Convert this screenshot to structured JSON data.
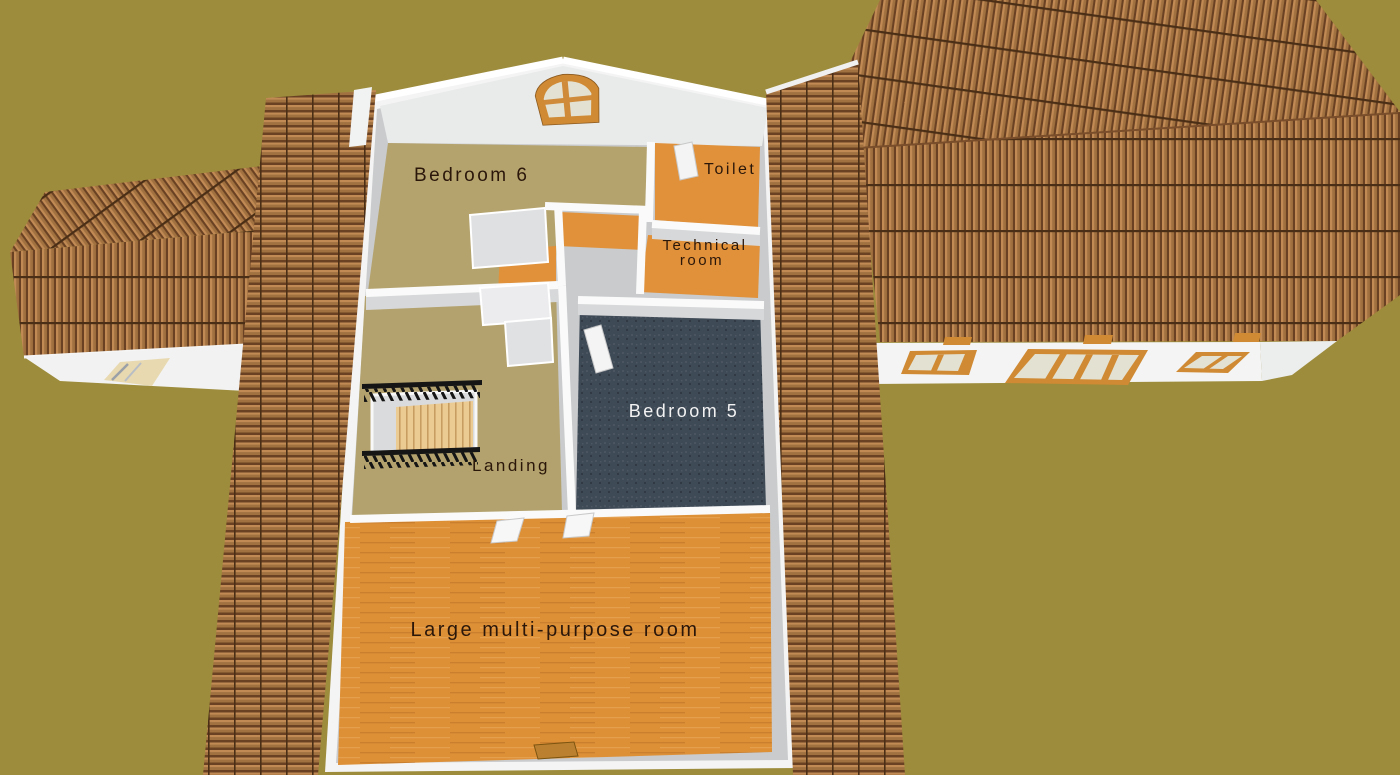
{
  "view": {
    "type": "3d-aerial-home-view",
    "background_color": "#9d8c3b"
  },
  "rooms": [
    {
      "id": "bedroom-6",
      "label": "Bedroom 6",
      "floor_color": "#b5a36e",
      "label_color": "#2b170a"
    },
    {
      "id": "toilet",
      "label": "Toilet",
      "floor_color": "#e0913a",
      "label_color": "#2b170a"
    },
    {
      "id": "technical-room",
      "label": "Technical room",
      "label_line1": "Technical",
      "label_line2": "room",
      "floor_color": "#e0913a",
      "label_color": "#2b170a"
    },
    {
      "id": "bedroom-5",
      "label": "Bedroom 5",
      "floor_color": "#3f4a57",
      "label_color": "#f2f2f2"
    },
    {
      "id": "landing",
      "label": "Landing",
      "floor_color": "#b3a26d",
      "label_color": "#2b170a"
    },
    {
      "id": "large-multi-purpose-room",
      "label": "Large multi-purpose room",
      "floor_color": "#de9037",
      "label_color": "#2b170a"
    }
  ],
  "colors": {
    "roof_tile_mid": "#a1713f",
    "roof_tile_light": "#c18a55",
    "roof_tile_dark": "#6a4223",
    "roof_tile_groove": "#4a2e15",
    "wall_white": "#f4f4f4",
    "wall_gray": "#c9cbcc",
    "window_frame": "#d08a33",
    "window_glass": "#e3e1d2",
    "stair_rail": "#151515",
    "stair_wood": "#eccb92"
  }
}
